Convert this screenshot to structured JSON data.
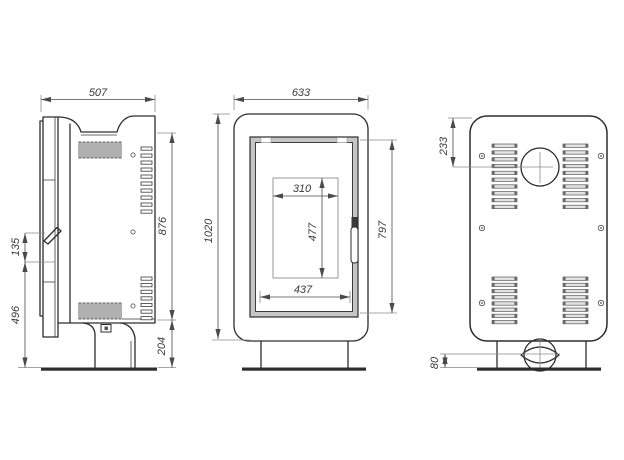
{
  "colors": {
    "line": "#2d2d2d",
    "dimension": "#4a4a4a",
    "extension": "#8a8a8a",
    "door_frame_fill": "#c6c6c6",
    "slat_fill": "#e2e2e2",
    "slat_end": "#6a6a6a",
    "background": "#ffffff"
  },
  "views": {
    "side": {
      "width": "507",
      "handle_span": "135",
      "handle_height": "496",
      "panel_height": "876",
      "base_height": "204"
    },
    "front": {
      "width": "633",
      "total_height": "1020",
      "glass_width": "310",
      "glass_height": "477",
      "door_opening_width": "437",
      "door_height": "797"
    },
    "back": {
      "flue_center_from_top": "233",
      "inlet_center_from_floor": "80"
    }
  }
}
